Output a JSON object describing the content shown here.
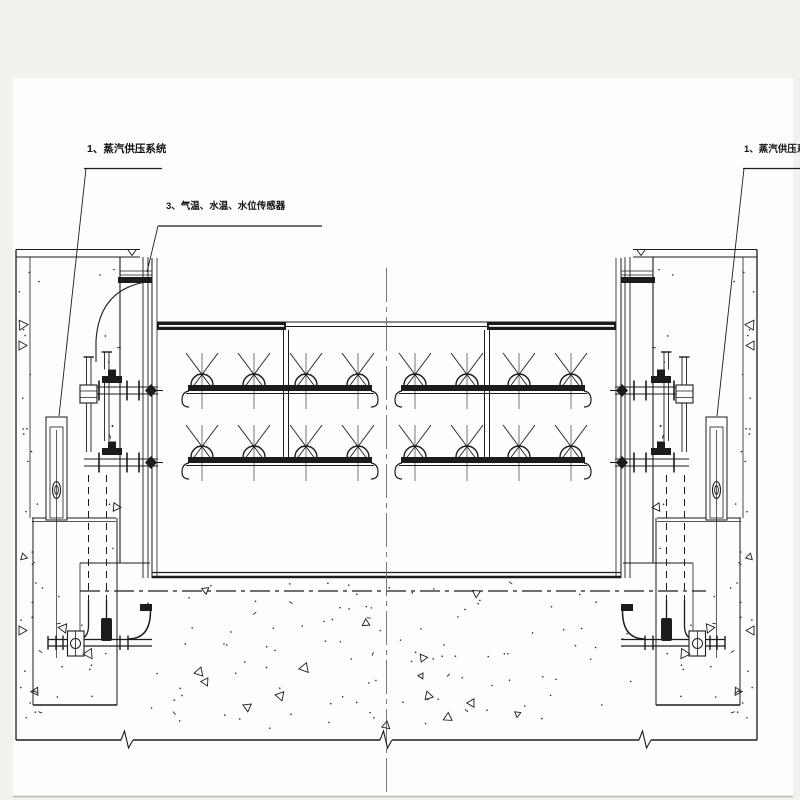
{
  "canvas": {
    "margin_color": "#f1f1ed",
    "paper_color": "#fdfdfb",
    "ink_color": "#1c1c1c",
    "centerline_color": "#6a6a6a"
  },
  "labels": {
    "steam_supply_left": {
      "text": "1、蒸汽供压系统"
    },
    "sensors": {
      "text": "3、气温、水温、水位传感器"
    },
    "steam_supply_right": {
      "text": "1、蒸汽供压系统"
    }
  }
}
